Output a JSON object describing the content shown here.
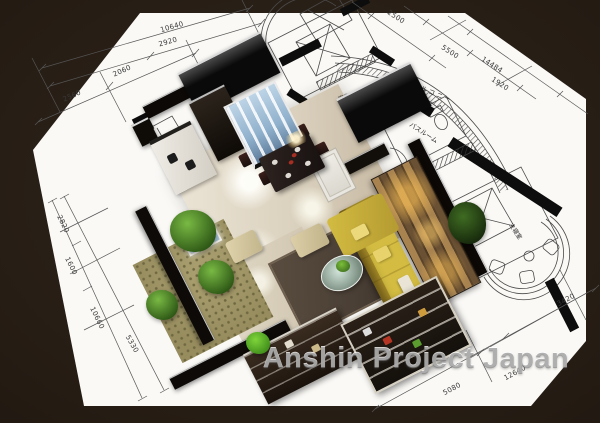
{
  "watermark": {
    "text": "Anshin Project Japan"
  },
  "plan": {
    "room_labels": [
      {
        "id": "kitchen",
        "text": "キッチン"
      },
      {
        "id": "bedroom",
        "text": "寝室"
      },
      {
        "id": "balcony",
        "text": "バルコニー"
      },
      {
        "id": "bathroom",
        "text": "バスルーム"
      },
      {
        "id": "master-bedroom",
        "text": "主寝室"
      }
    ],
    "dimensions": [
      {
        "text": "10640"
      },
      {
        "text": "2920"
      },
      {
        "text": "2560"
      },
      {
        "text": "2060"
      },
      {
        "text": "2820"
      },
      {
        "text": "1600"
      },
      {
        "text": "10660"
      },
      {
        "text": "5330"
      },
      {
        "text": "2500"
      },
      {
        "text": "5500"
      },
      {
        "text": "14484"
      },
      {
        "text": "1920"
      },
      {
        "text": "3420"
      },
      {
        "text": "5080"
      },
      {
        "text": "12640"
      }
    ]
  },
  "palette": {
    "frame": "#241b13",
    "paper": "#faf9f6",
    "floor_marble": "#d9cfbc",
    "rug": "#4a3f35",
    "sofa_yellow": "#d3bc41",
    "closet_blue": "#8fb0cc",
    "wood_light": "#a8834f",
    "wood_dark": "#6b5133",
    "plant_green": "#2d5715",
    "garden_floor": "#968c5e",
    "line": "#4a4a4a",
    "watermark_color": "rgba(128,128,128,0.6)"
  }
}
